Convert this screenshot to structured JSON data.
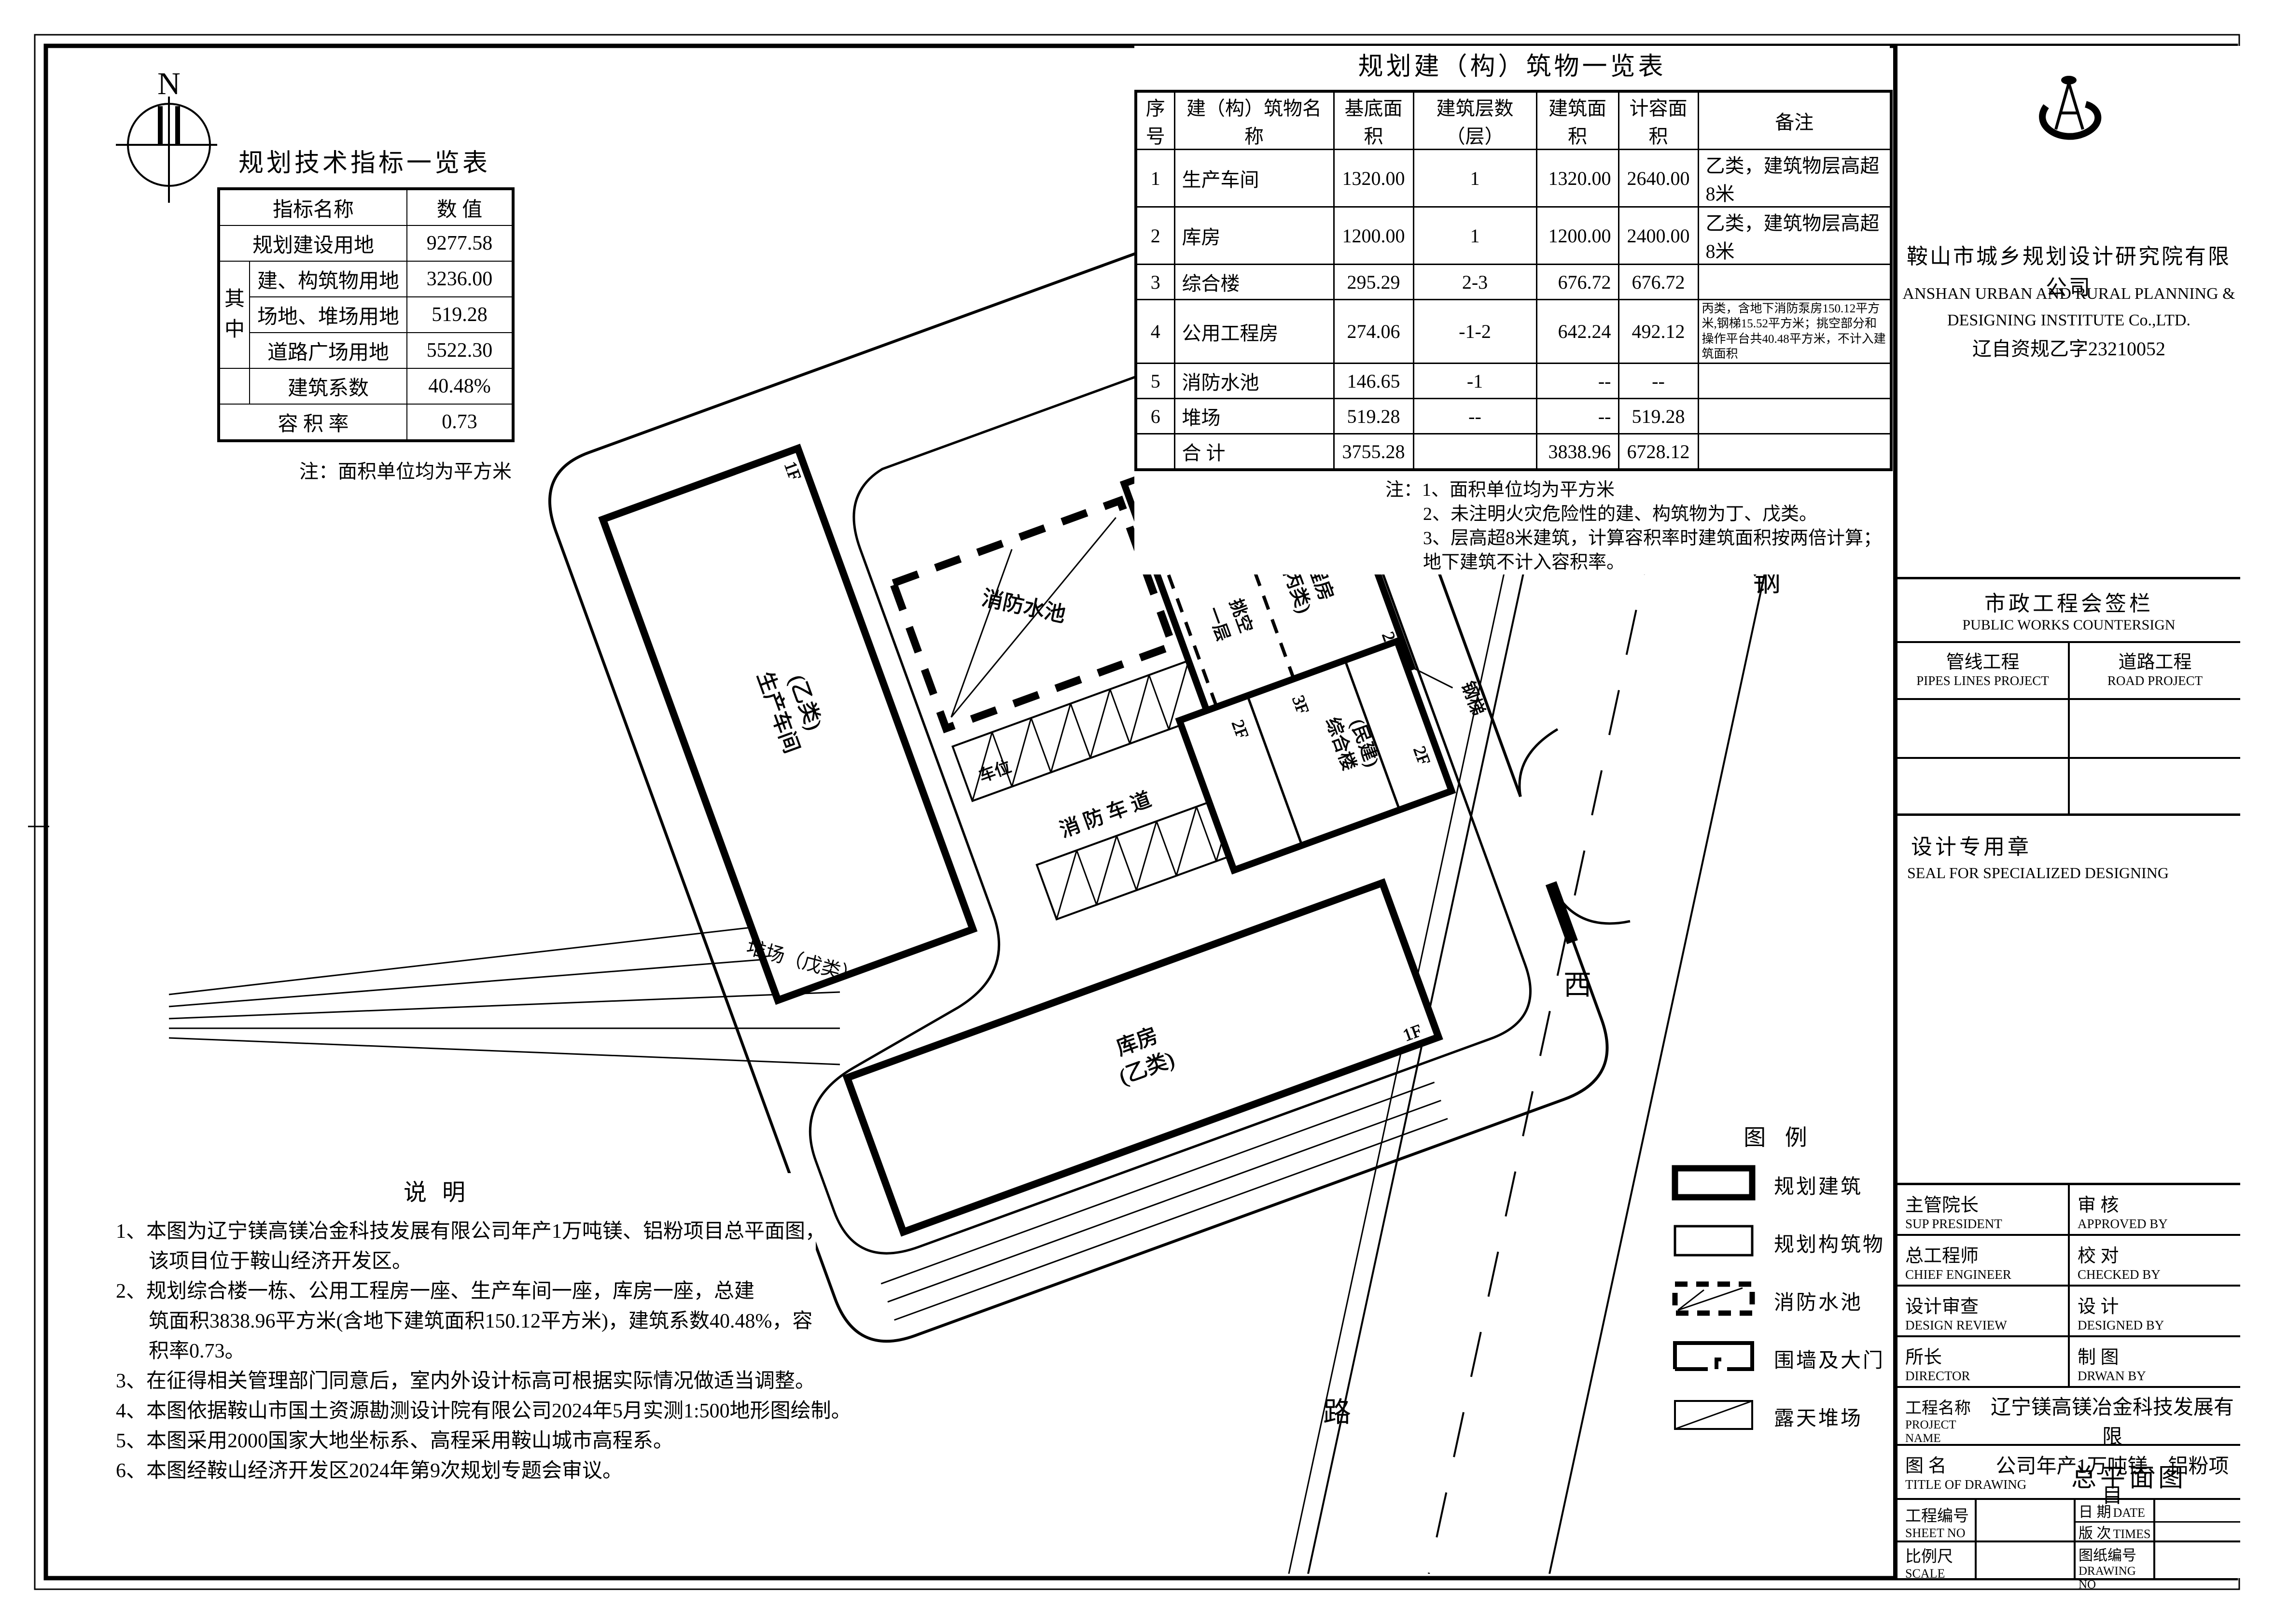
{
  "tech_table": {
    "title": "规划技术指标一览表",
    "header": {
      "name": "指标名称",
      "value": "数  值"
    },
    "among": "其 中",
    "rows": [
      {
        "name": "规划建设用地",
        "value": "9277.58"
      },
      {
        "name": "建、构筑物用地",
        "value": "3236.00"
      },
      {
        "name": "场地、堆场用地",
        "value": "519.28"
      },
      {
        "name": "道路广场用地",
        "value": "5522.30"
      },
      {
        "name": "建筑系数",
        "value": "40.48%"
      },
      {
        "name": "容 积 率",
        "value": "0.73"
      }
    ],
    "note": "注：面积单位均为平方米"
  },
  "btable": {
    "title": "规划建（构）筑物一览表",
    "headers": [
      "序号",
      "建（构）筑物名称",
      "基底面积",
      "建筑层数（层）",
      "建筑面积",
      "计容面积",
      "备注"
    ],
    "rows": [
      [
        "1",
        "生产车间",
        "1320.00",
        "1",
        "1320.00",
        "2640.00",
        "乙类，建筑物层高超8米"
      ],
      [
        "2",
        "库房",
        "1200.00",
        "1",
        "1200.00",
        "2400.00",
        "乙类，建筑物层高超8米"
      ],
      [
        "3",
        "综合楼",
        "295.29",
        "2-3",
        "676.72",
        "676.72",
        ""
      ],
      [
        "4",
        "公用工程房",
        "274.06",
        "-1-2",
        "642.24",
        "492.12",
        "丙类，含地下消防泵房150.12平方米,钢梯15.52平方米；挑空部分和操作平台共40.48平方米，不计入建筑面积"
      ],
      [
        "5",
        "消防水池",
        "146.65",
        "-1",
        "--",
        "--",
        ""
      ],
      [
        "6",
        "堆场",
        "519.28",
        "--",
        "--",
        "519.28",
        ""
      ]
    ],
    "total": [
      "",
      "合  计",
      "3755.28",
      "",
      "3838.96",
      "6728.12",
      ""
    ],
    "notes": [
      "注：1、面积单位均为平方米",
      "2、未注明火灾危险性的建、构筑物为丁、戊类。",
      "3、层高超8米建筑，计算容积率时建筑面积按两倍计算；地下建筑不计入容积率。"
    ]
  },
  "company": {
    "cn": "鞍山市城乡规划设计研究院有限公司",
    "en1": "ANSHAN URBAN AND RURAL PLANNING &",
    "en2": "DESIGNING INSTITUTE Co.,LTD.",
    "license": "辽自资规乙字23210052"
  },
  "countersign": {
    "title_cn": "市政工程会签栏",
    "title_en": "PUBLIC WORKS COUNTERSIGN",
    "col1_cn": "管线工程",
    "col1_en": "PIPES LINES PROJECT",
    "col2_cn": "道路工程",
    "col2_en": "ROAD PROJECT"
  },
  "seal": {
    "cn": "设计专用章",
    "en": "SEAL FOR SPECIALIZED DESIGNING"
  },
  "sign_rows": [
    {
      "l_cn": "主管院长",
      "l_en": "SUP PRESIDENT",
      "r_cn": "审 核",
      "r_en": "APPROVED BY"
    },
    {
      "l_cn": "总工程师",
      "l_en": "CHIEF ENGINEER",
      "r_cn": "校 对",
      "r_en": "CHECKED BY"
    },
    {
      "l_cn": "设计审查",
      "l_en": "DESIGN REVIEW",
      "r_cn": "设 计",
      "r_en": "DESIGNED BY"
    },
    {
      "l_cn": "所长",
      "l_en": "DIRECTOR",
      "r_cn": "制 图",
      "r_en": "DRWAN BY"
    }
  ],
  "project": {
    "cn": "工程名称",
    "en": "PROJECT NAME",
    "value1": "辽宁镁高镁冶金科技发展有限",
    "value2": "公司年产1万吨镁、铝粉项目"
  },
  "drawing": {
    "cn": "图  名",
    "en": "TITLE OF DRAWING",
    "value": "总平面图"
  },
  "fields": {
    "sheet_cn": "工程编号",
    "sheet_en": "SHEET NO",
    "date_cn": "日 期",
    "date_en": "DATE",
    "times_cn": "版 次",
    "times_en": "TIMES",
    "scale_cn": "比例尺",
    "scale_en": "SCALE",
    "dwg_cn": "图纸编号",
    "dwg_en": "DRAWING NO"
  },
  "legend": {
    "title": "图    例",
    "items": [
      "规划建筑",
      "规划构筑物",
      "消防水池",
      "围墙及大门",
      "露天堆场"
    ]
  },
  "notes": {
    "title": "说    明",
    "lines": [
      "1、本图为辽宁镁高镁冶金科技发展有限公司年产1万吨镁、铝粉项目总平面图，",
      "该项目位于鞍山经济开发区。",
      "2、规划综合楼一栋、公用工程房一座、生产车间一座，库房一座，总建",
      "筑面积3838.96平方米(含地下建筑面积150.12平方米)，建筑系数40.48%，容",
      "积率0.73。",
      "3、在征得相关管理部门同意后，室内外设计标高可根据实际情况做适当调整。",
      "4、本图依据鞍山市国土资源勘测设计院有限公司2024年5月实测1:500地形图绘制。",
      "5、本图采用2000国家大地坐标系、高程采用鞍山城市高程系。",
      "6、本图经鞍山经济开发区2024年第9次规划专题会审议。"
    ]
  },
  "plan": {
    "n": "N",
    "shengchan1": "生产车间",
    "shengchan2": "(乙类)",
    "kufang1": "库房",
    "kufang2": "(乙类)",
    "pool": "消防水池",
    "utility1": "公用工程房",
    "utility2": "(丙类)",
    "tk1": "一层",
    "tk2": "挑空",
    "gangti": "钢梯",
    "chewei": "车位",
    "lane": "消防车道",
    "duichang": "堆场（戊类）",
    "zh1": "综合楼",
    "zh2": "(民建)",
    "f1": "1F",
    "f2": "2F",
    "f3": "3F",
    "d1": "1D",
    "f2d1": "2F/1D",
    "road1": "钢",
    "road2": "西",
    "road3": "路"
  }
}
